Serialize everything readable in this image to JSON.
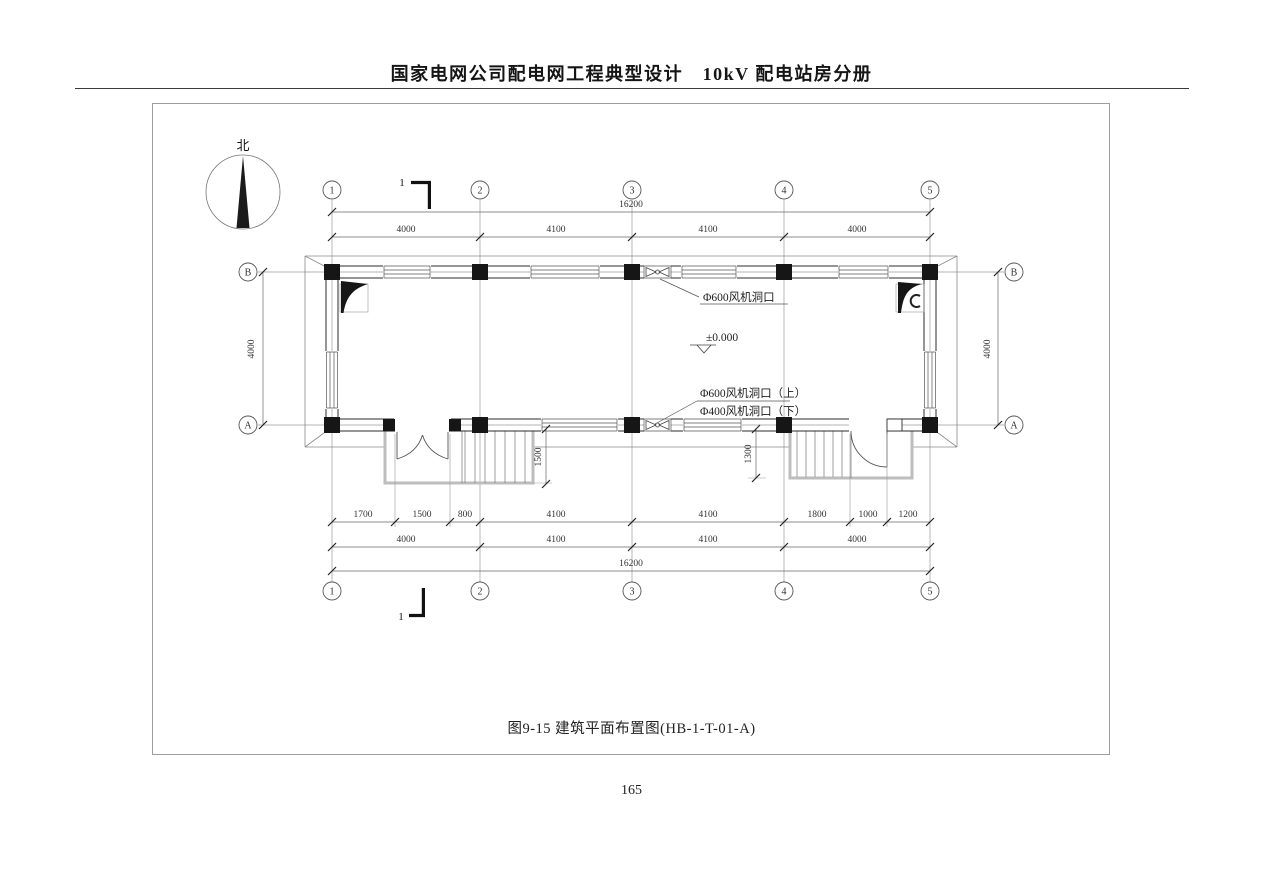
{
  "header": {
    "title": "国家电网公司配电网工程典型设计　10kV 配电站房分册"
  },
  "footer": {
    "page_number": "165"
  },
  "drawing": {
    "caption": "图9-15 建筑平面布置图(HB-1-T-01-A)",
    "north_label": "北",
    "grid_cols": [
      "1",
      "2",
      "3",
      "4",
      "5"
    ],
    "grid_rows": [
      "A",
      "B"
    ],
    "section_mark": "1",
    "elevation": "±0.000",
    "labels": {
      "fan_top": "Φ600风机洞口",
      "fan_bottom_upper": "Φ600风机洞口（上）",
      "fan_bottom_lower": "Φ400风机洞口（下）"
    },
    "dims": {
      "top_overall": "16200",
      "top_spans": [
        "4000",
        "4100",
        "4100",
        "4000"
      ],
      "side_left": "4000",
      "side_right": "4000",
      "bottom_detail": [
        "1700",
        "1500",
        "800",
        "4100",
        "4100",
        "1800",
        "1000",
        "1200"
      ],
      "bottom_spans": [
        "4000",
        "4100",
        "4100",
        "4000"
      ],
      "bottom_overall": "16200",
      "porch_left": "1500",
      "porch_right": "1300"
    }
  }
}
